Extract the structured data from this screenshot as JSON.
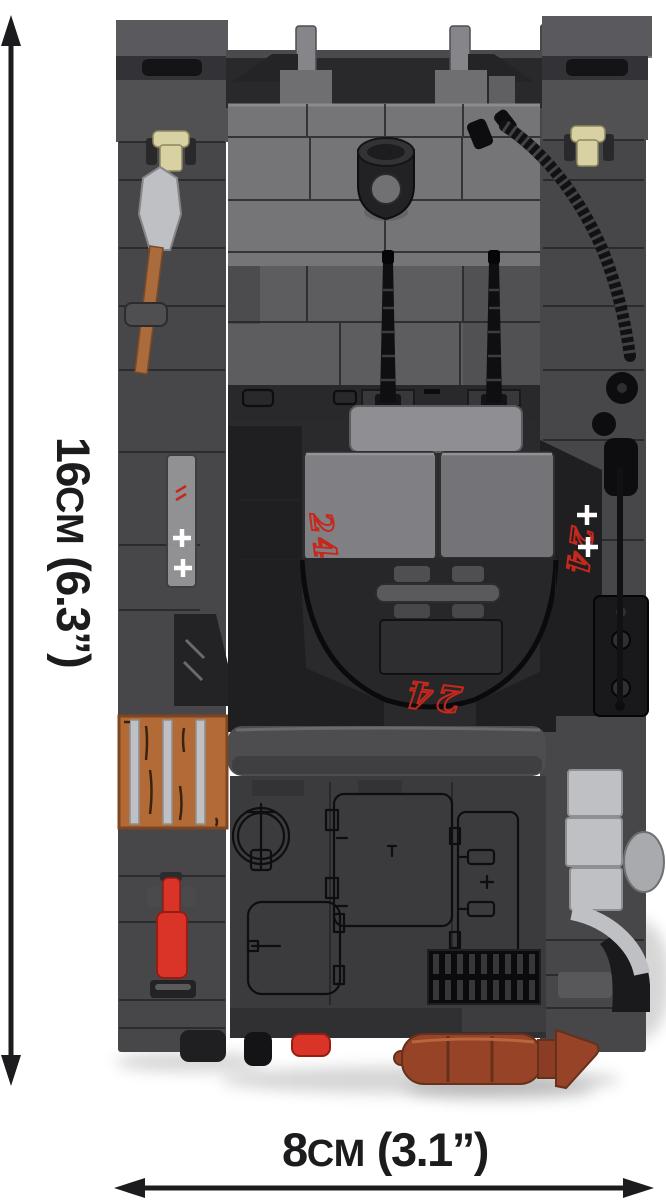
{
  "product": {
    "subject": "cobi-brick-armored-vehicle-top-view"
  },
  "dimensions": {
    "height": {
      "value": "16",
      "unit": "cm",
      "imperial": "(6.3”)"
    },
    "width": {
      "value": "8",
      "unit": "cm",
      "imperial": "(3.1”)"
    }
  },
  "markings": {
    "tactical_number": "24"
  },
  "palette": {
    "bg": "#ffffff",
    "ink": "#1c1c1e",
    "marking": "#c6281c",
    "fender": "#47474a",
    "fender-dark": "#333337",
    "fender-light": "#5a5a5e",
    "box-grey": "#515154",
    "glacis": "#757578",
    "glacis-light": "#8c8c90",
    "driver": "#5d5d60",
    "black-part": "#141417",
    "band": "#29292c",
    "plate": "#8f8f93",
    "hatch": "#808084",
    "hatch-dark": "#747478",
    "casemate": "#2a2a2d",
    "casemate-deep": "#1f1f22",
    "mid-band": "#4d4d50",
    "deck": "#3b3b3e",
    "deck-dark": "#303033",
    "print": "#0e0e10",
    "seam": "#242428",
    "silver": "#bec0c3",
    "silver-dark": "#8d8f92",
    "crate": "#b26b36",
    "crate-dark": "#7d4620",
    "wood": "#3a2210",
    "handle": "#aa6b3d",
    "clip": "#d7d1a3",
    "red": "#d93427",
    "red-dark": "#941d14",
    "rust": "#964327",
    "rust-dark": "#66301b",
    "cable": "#111114",
    "cable-rib": "#434347",
    "white": "#ffffff",
    "shadow": "rgba(17,17,17,0.16)"
  }
}
